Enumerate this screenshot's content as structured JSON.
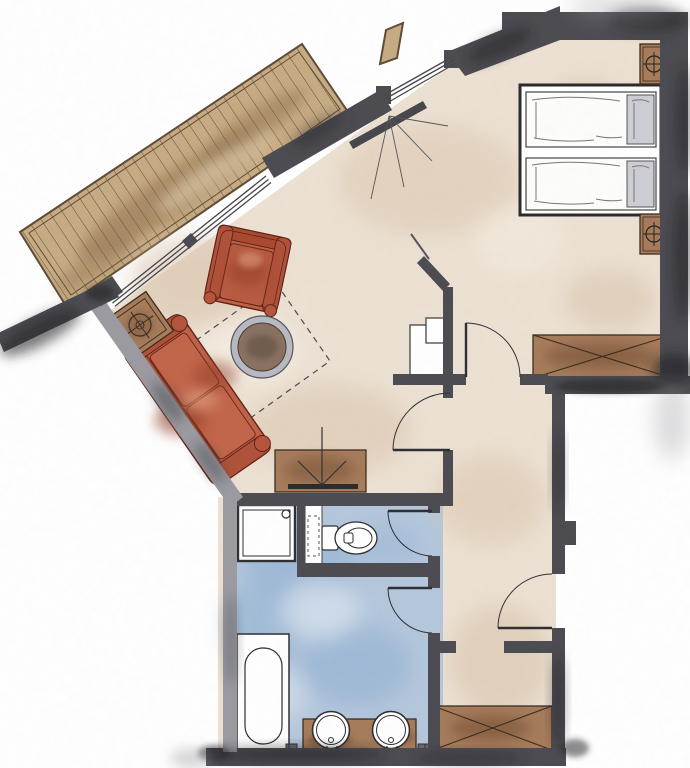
{
  "palette": {
    "bg": "#ffffff",
    "floor": "#ece1d3",
    "bath_floor": "#b4c7dc",
    "wall": "#4b4b51",
    "wall_light": "#9a9aa1",
    "line": "#2e2e33",
    "glass": "#46464c",
    "deck_wood": "#c7ab83",
    "deck_line": "#5d4c35",
    "cabinet_brown": "#a67c5b",
    "brown_dark": "#3c2d1e",
    "table_top": "#8a7263",
    "metal_gray": "#b7bac2",
    "pillow_gray": "#cdced4",
    "furniture_red": "#bf6149",
    "furniture_red_mid": "#b0513a",
    "furniture_red_deep": "#5f2316",
    "furniture_red_dark": "#8e3a22",
    "fixture_white": "#ffffff",
    "dash": "#4a4a4f"
  },
  "plan": {
    "areas": [
      {
        "name": "terrace-deck"
      },
      {
        "name": "living-area"
      },
      {
        "name": "bedroom"
      },
      {
        "name": "hallway"
      },
      {
        "name": "entry"
      },
      {
        "name": "bathroom"
      },
      {
        "name": "wc"
      }
    ],
    "fixtures": [
      {
        "name": "privacy-wall"
      },
      {
        "name": "sliding-terrace-door"
      },
      {
        "name": "window-band-living"
      },
      {
        "name": "window-entry"
      },
      {
        "name": "sofa"
      },
      {
        "name": "armchair"
      },
      {
        "name": "coffee-table"
      },
      {
        "name": "side-table-lamp"
      },
      {
        "name": "tv-sideboard"
      },
      {
        "name": "rug-outline"
      },
      {
        "name": "bed-single-1"
      },
      {
        "name": "bed-single-2"
      },
      {
        "name": "nightstand-lamp-1"
      },
      {
        "name": "nightstand-lamp-2"
      },
      {
        "name": "wardrobe-bedroom"
      },
      {
        "name": "wardrobe-entry"
      },
      {
        "name": "shower"
      },
      {
        "name": "toilet"
      },
      {
        "name": "cistern-prewall"
      },
      {
        "name": "bathtub"
      },
      {
        "name": "vanity-double-sink"
      },
      {
        "name": "door-living"
      },
      {
        "name": "door-bedroom"
      },
      {
        "name": "door-wc"
      },
      {
        "name": "door-bathroom"
      },
      {
        "name": "door-entrance"
      },
      {
        "name": "duct-shaft"
      }
    ]
  }
}
